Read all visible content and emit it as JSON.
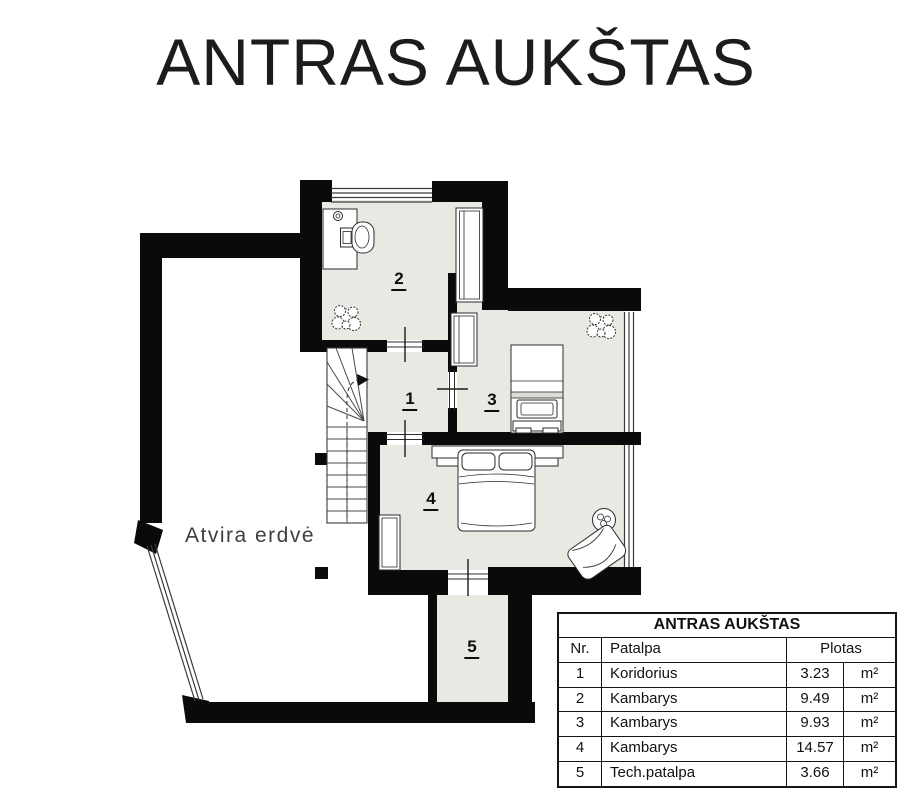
{
  "page_title": "ANTRAS AUKŠTAS",
  "plan": {
    "open_space_label": "Atvira erdvė",
    "room_numbers": {
      "r1": "1",
      "r2": "2",
      "r3": "3",
      "r4": "4",
      "r5": "5"
    }
  },
  "legend_table": {
    "title": "ANTRAS AUKŠTAS",
    "col_nr": "Nr.",
    "col_room": "Patalpa",
    "col_area": "Plotas",
    "rows": [
      {
        "nr": "1",
        "room": "Koridorius",
        "area": "3.23",
        "unit": "m²"
      },
      {
        "nr": "2",
        "room": "Kambarys",
        "area": "9.49",
        "unit": "m²"
      },
      {
        "nr": "3",
        "room": "Kambarys",
        "area": "9.93",
        "unit": "m²"
      },
      {
        "nr": "4",
        "room": "Kambarys",
        "area": "14.57",
        "unit": "m²"
      },
      {
        "nr": "5",
        "room": "Tech.patalpa",
        "area": "3.66",
        "unit": "m²"
      }
    ]
  },
  "colors": {
    "wall": "#0a0a0a",
    "floor": "#e9e9e4",
    "line": "#333333",
    "text": "#1b1b1b"
  }
}
